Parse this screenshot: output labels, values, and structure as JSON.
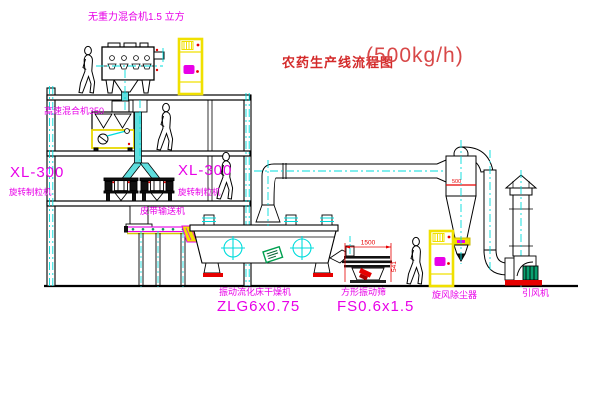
{
  "title": {
    "text": "农药生产线流程图",
    "capacity": "(500kg/h)"
  },
  "labels": {
    "gravity_mixer": "无重力混合机1.5 立方",
    "high_speed_mixer": "高速混合机350",
    "granulator_left_model": "XL-300",
    "granulator_left_name": "旋转制粒机",
    "granulator_right_model": "XL-300",
    "granulator_right_name": "旋转制粒机",
    "belt_conveyor": "皮带输送机",
    "dryer_name": "振动流化床干燥机",
    "dryer_model": "ZLG6x0.75",
    "screen_name": "方形振动筛",
    "screen_model": "FS0.6x1.5",
    "cyclone": "旋风除尘器",
    "fan": "引风机"
  },
  "dimensions": {
    "screen_width": "1500",
    "screen_height": "541",
    "cyclone_band": "500"
  },
  "colors": {
    "label_magenta": "#e800e8",
    "title_red": "#d42a2a",
    "centerline_cyan": "#00dcdc",
    "highlight_yellow": "#f0e000",
    "alert_red": "#e60000",
    "machine_green": "#00a050"
  }
}
